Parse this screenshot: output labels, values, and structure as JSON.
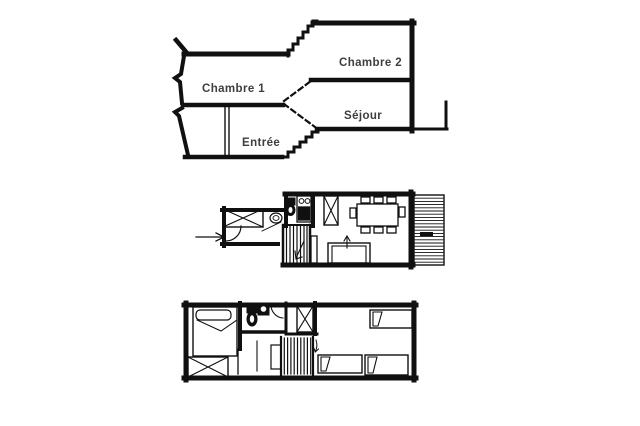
{
  "theme": {
    "background": "#ffffff",
    "wall_color": "#101010",
    "label_color": "#3e3e3e"
  },
  "section_view": {
    "kind": "split-level-cross-section",
    "labels": {
      "chambre1": "Chambre 1",
      "chambre2": "Chambre 2",
      "sejour": "Séjour",
      "entree": "Entrée"
    }
  },
  "upper_plan": {
    "kind": "floor-plan",
    "symbols": [
      "entry-arrow",
      "door-swing",
      "wardrobe",
      "washbasin",
      "wc-toilet",
      "kitchenette-hob",
      "kitchenette-sink",
      "staircase-down",
      "dining-table-8-chairs",
      "sofa",
      "balcony-decking"
    ]
  },
  "lower_plan": {
    "kind": "floor-plan",
    "symbols": [
      "double-bed",
      "wardrobe",
      "bathroom-toilet",
      "bathroom-washbasin",
      "door-swing",
      "closet",
      "staircase-up",
      "single-bed",
      "single-bed",
      "single-bed"
    ]
  }
}
